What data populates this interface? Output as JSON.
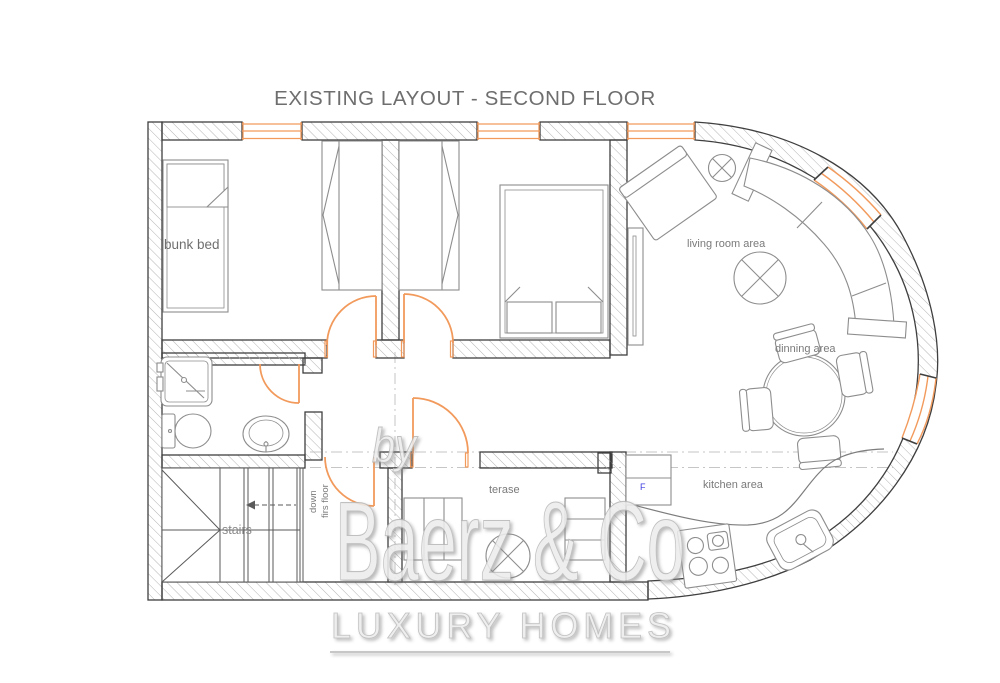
{
  "title": "EXISTING LAYOUT - SECOND FLOOR",
  "rooms": {
    "bunk_bed": "bunk bed",
    "living_room": "living room area",
    "dining": "dinning area",
    "kitchen": "kitchen area",
    "terrace": "terase",
    "stairs": "stairs",
    "stairs_note_line1": "down",
    "stairs_note_line2": "firs floor"
  },
  "annotations": {
    "fridge": "F"
  },
  "watermark": {
    "prefix": "by",
    "brand": "Baerz & Co",
    "tagline": "LUXURY HOMES"
  },
  "colors": {
    "window_door_orange": "#f29a5c",
    "wall_outline": "#3f3f3f",
    "hatch_gray": "#b4b4b4",
    "label_gray": "#7a7a7a",
    "furniture_gray": "#8d8d8d",
    "fridge_blue": "#3c3ce0",
    "watermark_gray": "#d4d4d4",
    "title_gray": "#6e6e6e"
  }
}
